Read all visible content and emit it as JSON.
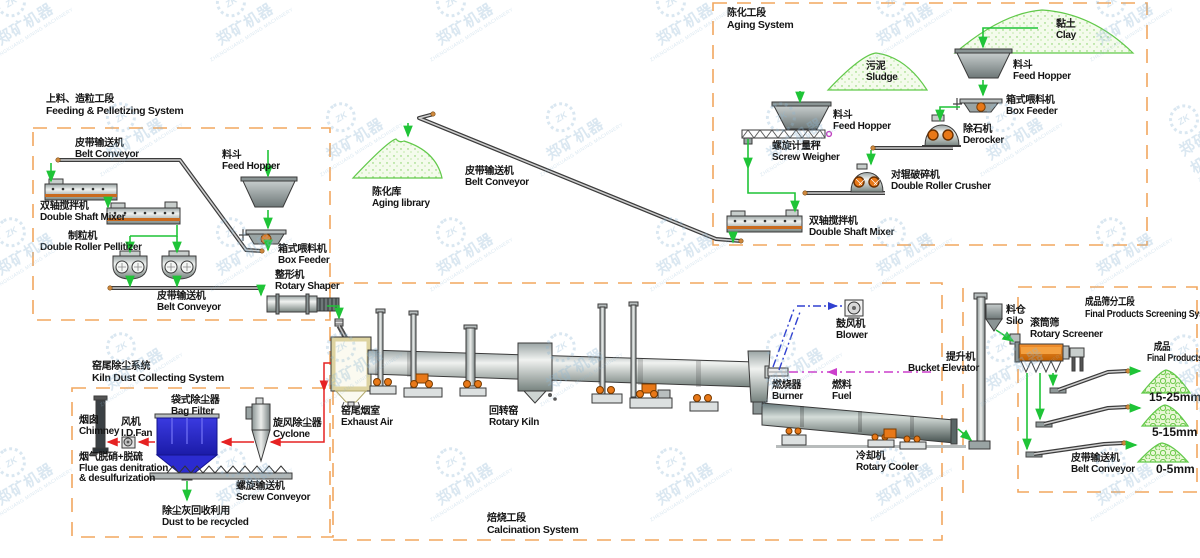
{
  "watermark": {
    "logo": "ZK",
    "text": "郑矿机器",
    "subtext": "ZHENGKUANG MINING MACHINERY"
  },
  "titles": {
    "feeding": {
      "zh": "上料、造粒工段",
      "en": "Feeding & Pelletizing System"
    },
    "aging": {
      "zh": "陈化工段",
      "en": "Aging System"
    },
    "calcination": {
      "zh": "焙烧工段",
      "en": "Calcination System"
    },
    "dust": {
      "zh": "窑尾除尘系统",
      "en": "Kiln Dust Collecting System"
    },
    "screening": {
      "zh": "成品筛分工段",
      "en": "Final Products Screening System"
    }
  },
  "labels": {
    "belt_top_feeding": {
      "zh": "皮带输送机",
      "en": "Belt Conveyor"
    },
    "feed_hopper_feeding": {
      "zh": "料斗",
      "en": "Feed Hopper"
    },
    "mixer_feeding": {
      "zh": "双轴搅拌机",
      "en": "Double Shaft Mixer"
    },
    "pellitizer": {
      "zh": "制粒机",
      "en": "Double Roller Pellitizer"
    },
    "box_feeder_feeding": {
      "zh": "箱式喂料机",
      "en": "Box Feeder"
    },
    "belt_bottom_feeding": {
      "zh": "皮带输送机",
      "en": "Belt Conveyor"
    },
    "shaper": {
      "zh": "整形机",
      "en": "Rotary Shaper"
    },
    "clay": {
      "zh": "黏土",
      "en": "Clay"
    },
    "feed_hopper_clay": {
      "zh": "料斗",
      "en": "Feed Hopper"
    },
    "box_feeder_clay": {
      "zh": "箱式喂料机",
      "en": "Box Feeder"
    },
    "derocker": {
      "zh": "除石机",
      "en": "Derocker"
    },
    "crusher": {
      "zh": "对辊破碎机",
      "en": "Double Roller Crusher"
    },
    "sludge": {
      "zh": "污泥",
      "en": "Sludge"
    },
    "feed_hopper_sludge": {
      "zh": "料斗",
      "en": "Feed Hopper"
    },
    "screw_weigher": {
      "zh": "螺旋计量秤",
      "en": "Screw Weigher"
    },
    "mixer_aging": {
      "zh": "双轴搅拌机",
      "en": "Double Shaft Mixer"
    },
    "aging_library": {
      "zh": "陈化库",
      "en": "Aging library"
    },
    "belt_aging": {
      "zh": "皮带输送机",
      "en": "Belt Conveyor"
    },
    "exhaust_air": {
      "zh": "窑尾烟室",
      "en": "Exhaust Air"
    },
    "rotary_kiln": {
      "zh": "回转窑",
      "en": "Rotary Kiln"
    },
    "blower": {
      "zh": "鼓风机",
      "en": "Blower"
    },
    "burner": {
      "zh": "燃烧器",
      "en": "Burner"
    },
    "fuel": {
      "zh": "燃料",
      "en": "Fuel"
    },
    "bucket_elevator": {
      "zh": "提升机",
      "en": "Bucket Elevator"
    },
    "cooler": {
      "zh": "冷却机",
      "en": "Rotary Cooler"
    },
    "silo": {
      "zh": "料仓",
      "en": "Silo"
    },
    "screener": {
      "zh": "滚筒筛",
      "en": "Rotary Screener"
    },
    "final_products": {
      "zh": "成品",
      "en": "Final Products"
    },
    "size1": {
      "text": "15-25mm"
    },
    "size2": {
      "text": "5-15mm"
    },
    "size3": {
      "text": "0-5mm"
    },
    "belt_screening": {
      "zh": "皮带输送机",
      "en": "Belt Conveyor"
    },
    "chimney": {
      "zh": "烟囱",
      "en": "Chimney"
    },
    "idfan": {
      "zh": "风机",
      "en": "I.D.Fan"
    },
    "bag_filter": {
      "zh": "袋式除尘器",
      "en": "Bag Filter"
    },
    "cyclone": {
      "zh": "旋风除尘器",
      "en": "Cyclone"
    },
    "flue_gas": {
      "zh": "烟气脱硝+脱硫",
      "en1": "Flue gas denitration",
      "en2": "& desulfurization"
    },
    "screw_conveyor": {
      "zh": "螺旋输送机",
      "en": "Screw Conveyor"
    },
    "dust_recycled": {
      "zh": "除尘灰回收利用",
      "en": "Dust to be recycled"
    }
  },
  "colors": {
    "flow_green": "#1fc437",
    "dust_red": "#e62222",
    "fuel_magenta": "#cc3fcc",
    "air_blue": "#3040d0",
    "border_orange": "#f2a75f",
    "equipment_orange": "#e87818",
    "bag_filter_blue": "#2b2bd0",
    "watermark_blue": "#8fb8d4"
  }
}
